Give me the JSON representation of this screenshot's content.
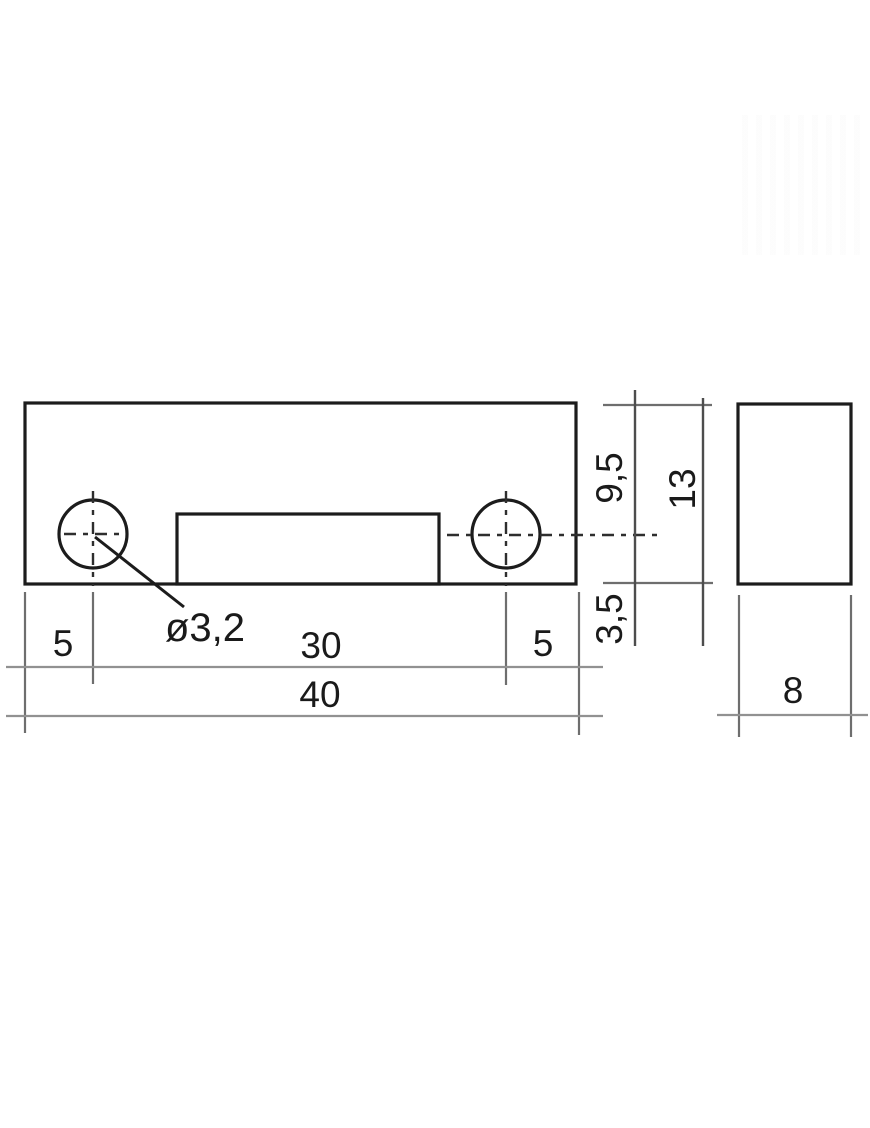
{
  "drawing": {
    "type": "orthographic-technical-drawing",
    "views": {
      "front_view": {
        "name": "front-view",
        "labels": {
          "offset_left": "5",
          "hole_spacing": "30",
          "offset_right": "5",
          "overall_width": "40",
          "hole_diameter": "ø3,2",
          "top_to_hole_center": "9,5",
          "overall_height": "13",
          "hole_center_to_bottom": "3,5"
        }
      },
      "side_view": {
        "name": "side-view",
        "labels": {
          "depth": "8"
        }
      }
    },
    "colors": {
      "background": "#ffffff",
      "part_fill": "#b1b1b1",
      "hole_fill": "#fafafa",
      "outline": "#1c1c1c",
      "dim_line": "#919191",
      "ext_line": "#6e6e6e",
      "vertical_dim_line": "#4d4d4d",
      "center_line": "#2e2e2e",
      "text": "#1a1a1a"
    }
  }
}
